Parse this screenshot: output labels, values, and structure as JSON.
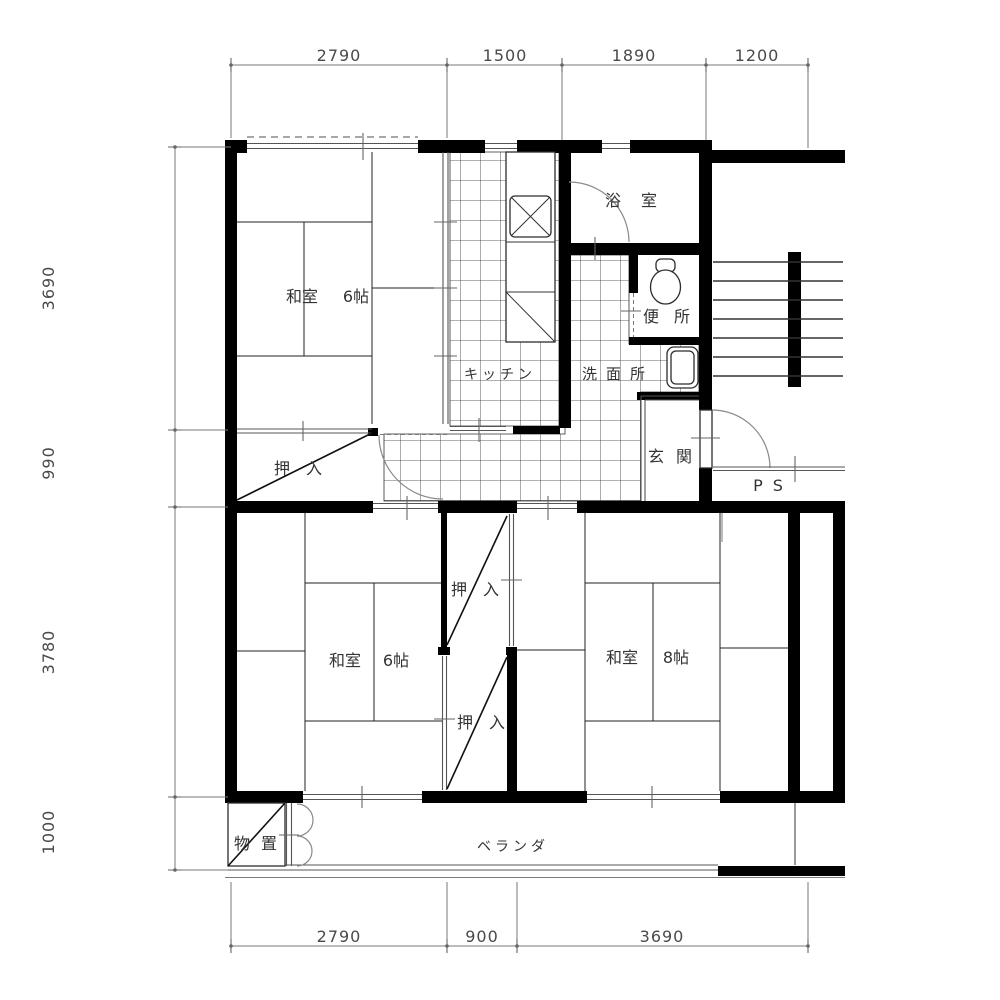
{
  "dims": {
    "top": [
      "2790",
      "1500",
      "1890",
      "1200"
    ],
    "left": [
      "3690",
      "990",
      "3780",
      "1000"
    ],
    "bottom": [
      "2790",
      "900",
      "3690"
    ]
  },
  "rooms": {
    "washitsu_upper_name": "和室",
    "washitsu_upper_size": "6帖",
    "washitsu_lower_left_name": "和室",
    "washitsu_lower_left_size": "6帖",
    "washitsu_lower_right_name": "和室",
    "washitsu_lower_right_size": "8帖",
    "kitchen": "キッチン",
    "bath": "浴室",
    "toilet": "便所",
    "washroom": "洗面所",
    "entrance": "玄関",
    "pipe_space": "PS",
    "closet_upper": "押入",
    "closet_mid_upper": "押入",
    "closet_mid_lower": "押入",
    "storage": "物置",
    "veranda": "ベランダ"
  },
  "colors": {
    "wall": "#000000",
    "thin_line": "#333333",
    "dimension_line": "#7a7a7a",
    "text": "#3a3a3a",
    "background": "#ffffff"
  }
}
